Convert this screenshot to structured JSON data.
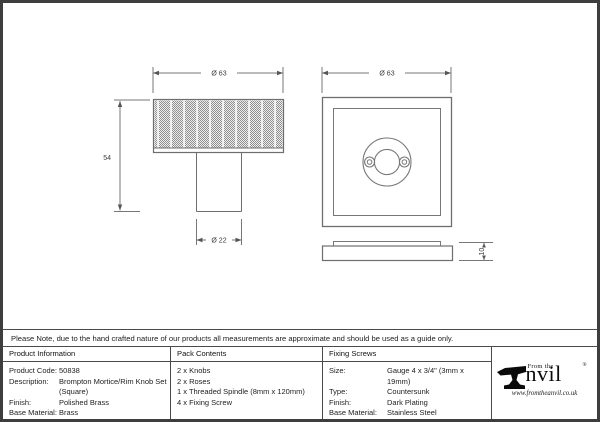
{
  "note": "Please Note, due to the hand crafted nature of our products all measurements are approximate and should be used as a guide only.",
  "drawings": {
    "knob_side_view": {
      "dim_head_diameter": "Ø 63",
      "dim_height": "54",
      "dim_stem_diameter": "Ø 22"
    },
    "rose_front_view": {
      "dim_width": "Ø 63"
    },
    "rose_side_view": {
      "dim_thickness": "10"
    }
  },
  "table": {
    "product_information": {
      "header": "Product Information",
      "rows": [
        {
          "label": "Product Code:",
          "value": "50838"
        },
        {
          "label": "Description:",
          "value": "Brompton Mortice/Rim Knob Set"
        },
        {
          "label": "",
          "value": "(Square)"
        },
        {
          "label": "Finish:",
          "value": "Polished Brass"
        },
        {
          "label": "Base Material:",
          "value": "Brass"
        }
      ]
    },
    "pack_contents": {
      "header": "Pack Contents",
      "items": [
        "2 x Knobs",
        "2 x Roses",
        "1 x Threaded Spindle (8mm x 120mm)",
        "4 x Fixing Screw"
      ]
    },
    "fixing_screws": {
      "header": "Fixing Screws",
      "rows": [
        {
          "label": "Size:",
          "value": "Gauge 4 x 3/4\" (3mm x 19mm)"
        },
        {
          "label": "Type:",
          "value": "Countersunk"
        },
        {
          "label": "Finish:",
          "value": "Dark Plating"
        },
        {
          "label": "Base Material:",
          "value": "Stainless Steel"
        }
      ]
    }
  },
  "logo": {
    "from_the": "From the",
    "name": "nvil",
    "registered": "®",
    "website": "www.fromtheanvil.co.uk"
  },
  "colors": {
    "line": "#777777",
    "dim_arrow": "#555555",
    "border": "#3e3e3e",
    "table_line": "#4a4a4a",
    "knurl_dark": "#8f8f8f",
    "knurl_light": "#ededed"
  }
}
